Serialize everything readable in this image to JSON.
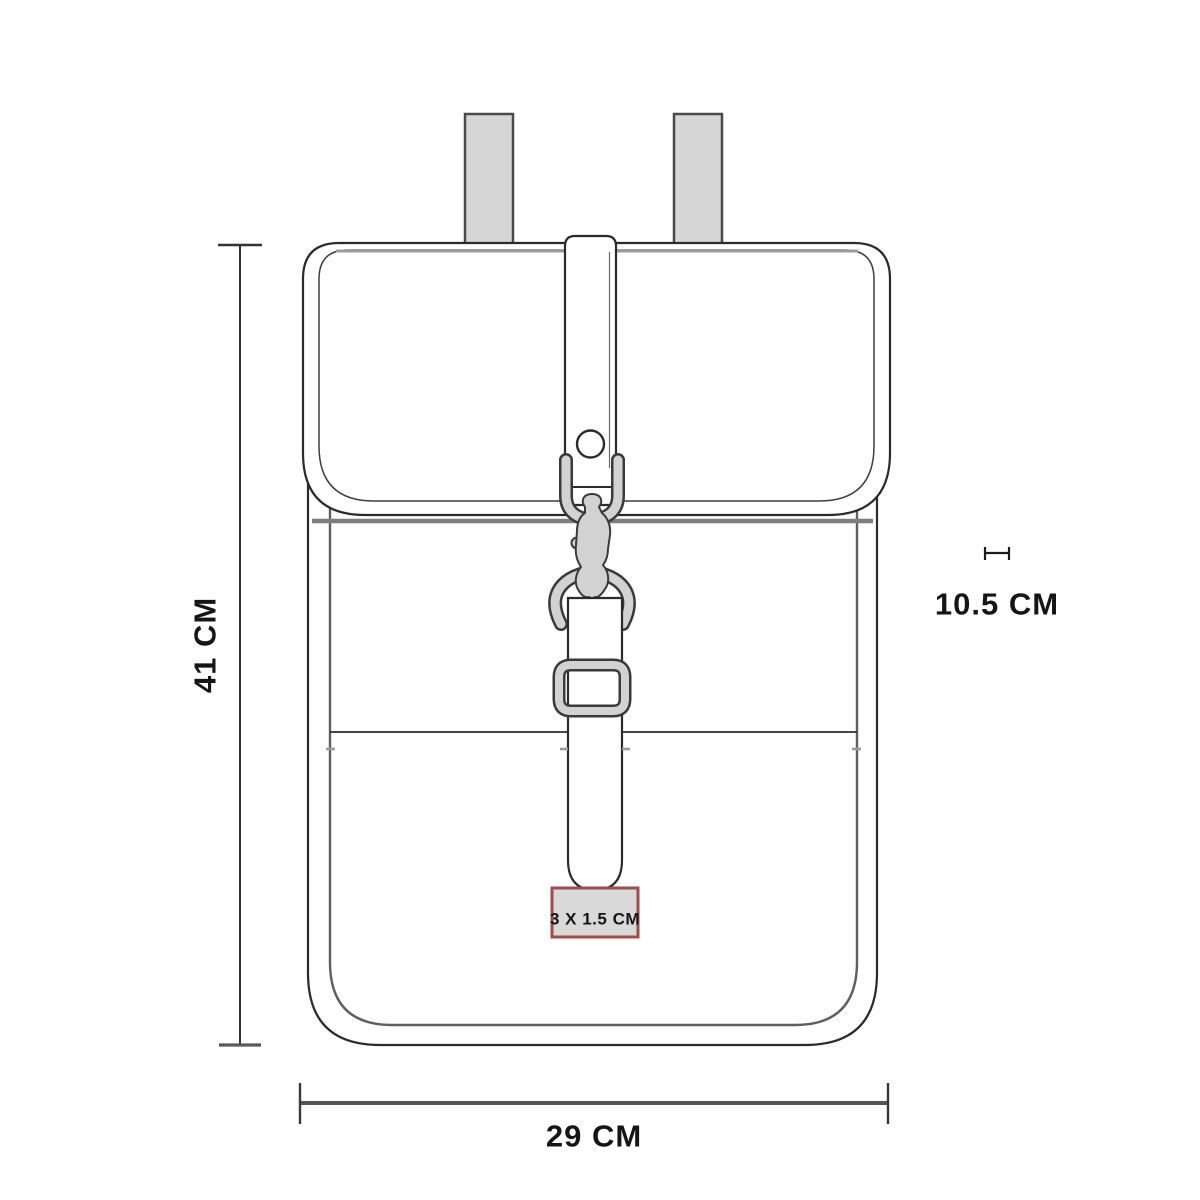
{
  "diagram": {
    "type": "product-dimension-diagram",
    "subject": "mini backpack line drawing, front view",
    "labels": {
      "height": "41 CM",
      "width": "29 CM",
      "strap_width": "10.5 CM",
      "patch_size": "3 X 1.5 CM"
    },
    "values": {
      "height_cm": 41,
      "width_cm": 29,
      "strap_width_cm": 10.5,
      "patch_width_cm": 3,
      "patch_height_cm": 1.5
    },
    "colors": {
      "line": "#2b2b2b",
      "inner_line": "#5f5f5f",
      "soft_line": "#7e7e7e",
      "highlight_line": "#9c9c9c",
      "strap_fill": "#d6d6d6",
      "metal_fill": "#d2d2d2",
      "metal_edge": "#3a3a3a",
      "patch_fill": "#d9d9d9",
      "patch_border": "#9e4d49",
      "text": "#151515",
      "background": "#ffffff"
    }
  }
}
